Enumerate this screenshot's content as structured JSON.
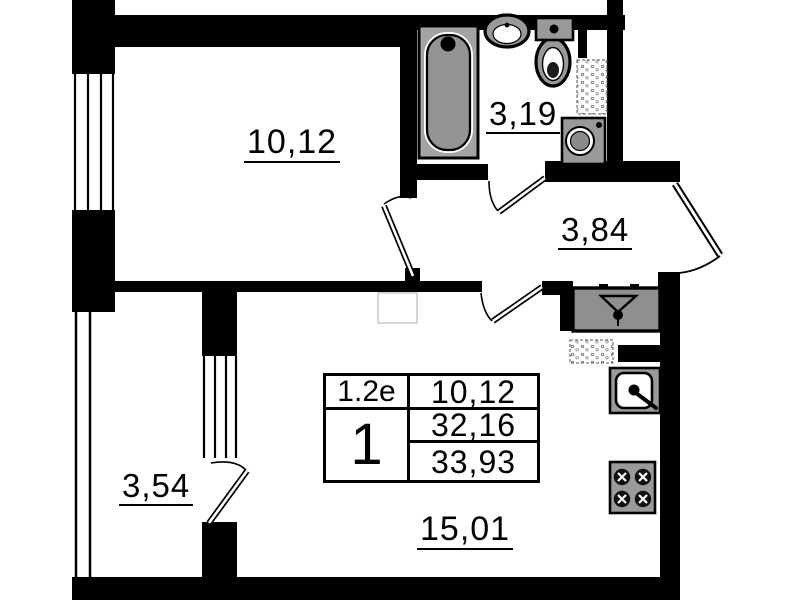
{
  "plan": {
    "rooms": {
      "bedroom": {
        "label": "10,12"
      },
      "bathroom": {
        "label": "3,19"
      },
      "hallway": {
        "label": "3,84"
      },
      "balcony": {
        "label": "3,54"
      },
      "living_kitchen": {
        "label": "15,01"
      }
    },
    "info_table": {
      "plan_code": "1.2e",
      "room_count": "1",
      "living_area": "10,12",
      "apartment_area": "32,16",
      "total_area": "33,93"
    },
    "colors": {
      "wall": "#000000",
      "fixture_fill": "#9a9a9a",
      "background": "#ffffff"
    }
  }
}
